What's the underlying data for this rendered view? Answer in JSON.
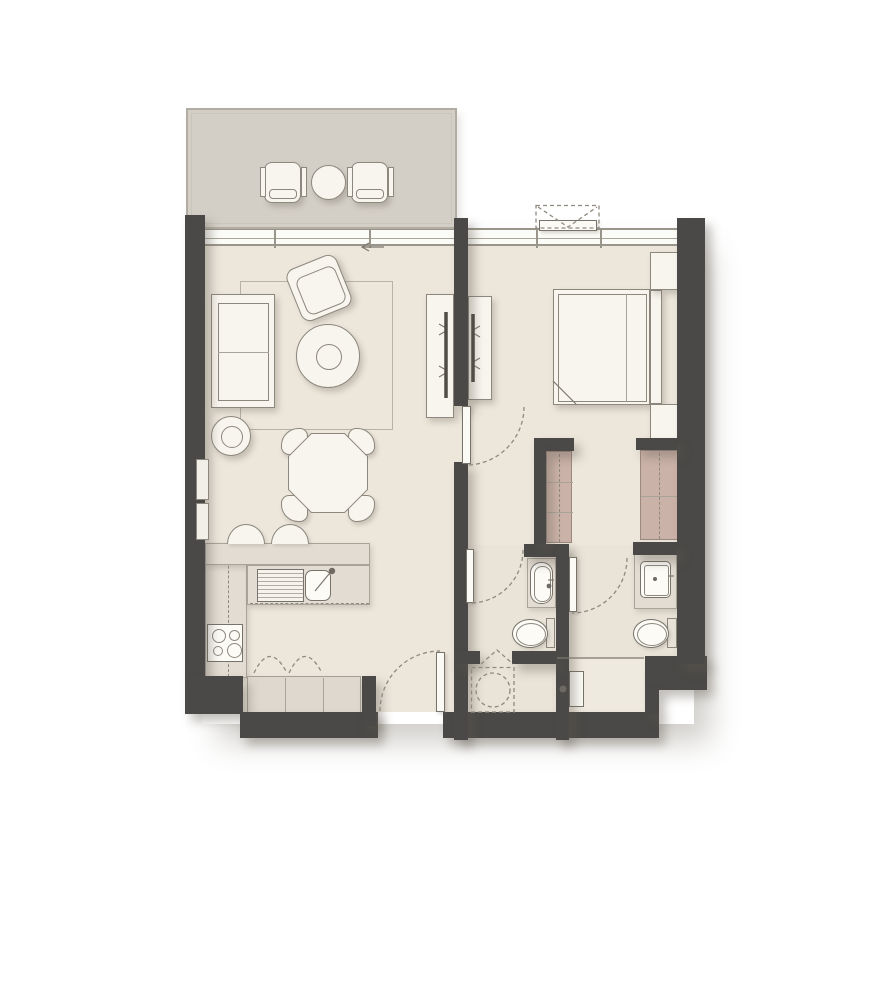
{
  "meta": {
    "title": "one-bedroom-apartment-floor-plan",
    "plan_type": "residential unit plan",
    "width": 889,
    "height": 1001
  },
  "colors": {
    "wall": "#4a4947",
    "floor": "#ece6db",
    "floor_bath": "#e9e3d8",
    "floor_light": "#efeadf",
    "balcony": "#d3cfc7",
    "furniture": "#f8f5ee",
    "furniture_line": "#8d887e",
    "counter": "#e2dcd2",
    "cabinet": "#ded8ce",
    "wardrobe": "#cbb2a8",
    "background": "#ffffff"
  },
  "rooms": [
    {
      "name": "balcony"
    },
    {
      "name": "living-dining-room"
    },
    {
      "name": "kitchen"
    },
    {
      "name": "entrance-hall"
    },
    {
      "name": "bedroom"
    },
    {
      "name": "bathroom"
    },
    {
      "name": "ensuite-bathroom"
    },
    {
      "name": "utility-closet"
    },
    {
      "name": "shower-area"
    }
  ],
  "elements": [
    {
      "name": "unit-shadow",
      "c": "shadow-rect",
      "x": 202,
      "y": 232,
      "w": 492,
      "h": 492
    },
    {
      "name": "balcony-floor",
      "c": "floor-balcony",
      "x": 187,
      "y": 109,
      "w": 269,
      "h": 119
    },
    {
      "name": "living-dining-floor",
      "c": "floor",
      "x": 205,
      "y": 228,
      "w": 250,
      "h": 484
    },
    {
      "name": "bedroom-floor",
      "c": "floor",
      "x": 455,
      "y": 228,
      "w": 222,
      "h": 317
    },
    {
      "name": "bathroom-floor",
      "c": "floor-bath",
      "x": 455,
      "y": 545,
      "w": 222,
      "h": 115
    },
    {
      "name": "utility-floor",
      "c": "floor-bath",
      "x": 455,
      "y": 660,
      "w": 190,
      "h": 52
    },
    {
      "name": "shower-floor",
      "c": "floor-light",
      "x": 568,
      "y": 659,
      "w": 77,
      "h": 53
    },
    {
      "name": "living-window-band",
      "c": "glass",
      "x": 205,
      "y": 228,
      "w": 250,
      "h": 18,
      "kids": [
        {
          "name": "window-rail",
          "c": "hline",
          "x": 0,
          "y": 8,
          "w": 250,
          "h": 1
        },
        {
          "name": "window-mullion",
          "c": "mull",
          "x": 69,
          "y": 0,
          "w": 2,
          "h": 18
        },
        {
          "name": "window-mullion",
          "c": "mull",
          "x": 164,
          "y": 0,
          "w": 2,
          "h": 18
        }
      ]
    },
    {
      "name": "bedroom-window-band",
      "c": "glass",
      "x": 468,
      "y": 228,
      "w": 209,
      "h": 18,
      "kids": [
        {
          "name": "window-rail",
          "c": "hline",
          "x": 0,
          "y": 8,
          "w": 209,
          "h": 1
        },
        {
          "name": "window-mullion",
          "c": "mull",
          "x": 68,
          "y": 0,
          "w": 2,
          "h": 18
        },
        {
          "name": "window-mullion",
          "c": "mull",
          "x": 132,
          "y": 0,
          "w": 2,
          "h": 18
        }
      ]
    },
    {
      "name": "living-rug",
      "c": "rug",
      "x": 240,
      "y": 281,
      "w": 153,
      "h": 149
    },
    {
      "name": "kitchen-counter-left",
      "c": "counter",
      "x": 205,
      "y": 543,
      "w": 42,
      "h": 135,
      "kids": [
        {
          "name": "counter-dash-line",
          "c": "dashv",
          "x": 22,
          "y": 2,
          "w": 1,
          "h": 131
        }
      ]
    },
    {
      "name": "kitchen-counter-bar",
      "c": "counter",
      "x": 205,
      "y": 543,
      "w": 165,
      "h": 22
    },
    {
      "name": "kitchen-counter-sink-run",
      "c": "counter",
      "x": 247,
      "y": 565,
      "w": 123,
      "h": 40,
      "kids": [
        {
          "name": "counter-dash-line",
          "c": "dashh",
          "x": 2,
          "y": 37,
          "w": 119,
          "h": 1
        }
      ]
    },
    {
      "name": "kitchen-lower-cabinets",
      "c": "cabinet",
      "x": 247,
      "y": 676,
      "w": 114,
      "h": 38,
      "kids": [
        {
          "name": "cabinet-divider",
          "c": "vline",
          "x": 37,
          "y": 1,
          "w": 1,
          "h": 36
        },
        {
          "name": "cabinet-divider",
          "c": "vline",
          "x": 75,
          "y": 1,
          "w": 1,
          "h": 36
        }
      ]
    },
    {
      "name": "sofa",
      "c": "furn",
      "x": 211,
      "y": 294,
      "w": 64,
      "h": 114,
      "kids": [
        {
          "name": "sofa-seat",
          "c": "hollow",
          "x": 6,
          "y": 8,
          "w": 51,
          "h": 98
        },
        {
          "name": "sofa-cushion-line",
          "c": "hline",
          "x": 6,
          "y": 57,
          "w": 51,
          "h": 1
        }
      ]
    },
    {
      "name": "side-table",
      "c": "furn circle",
      "x": 211,
      "y": 416,
      "w": 40,
      "h": 40,
      "kids": [
        {
          "name": "side-table-inner",
          "c": "hollow circle",
          "x": 9,
          "y": 9,
          "w": 22,
          "h": 22
        }
      ]
    },
    {
      "name": "armchair",
      "c": "furn",
      "x": 292,
      "y": 260,
      "w": 54,
      "h": 56,
      "r": -22,
      "br": "10px",
      "kids": [
        {
          "name": "armchair-seat",
          "c": "hollow",
          "x": 6,
          "y": 10,
          "w": 42,
          "h": 40,
          "br": "8px"
        }
      ]
    },
    {
      "name": "coffee-table",
      "c": "furn circle",
      "x": 296,
      "y": 324,
      "w": 64,
      "h": 64,
      "kids": [
        {
          "name": "coffee-table-ring",
          "c": "hollow circle",
          "x": 19,
          "y": 19,
          "w": 26,
          "h": 26
        }
      ]
    },
    {
      "name": "dining-chair",
      "c": "chair",
      "x": 281,
      "y": 428,
      "w": 27,
      "h": 27,
      "br": "65% 30% 30% 30%"
    },
    {
      "name": "dining-chair",
      "c": "chair",
      "x": 348,
      "y": 428,
      "w": 27,
      "h": 27,
      "br": "30% 65% 30% 30%"
    },
    {
      "name": "dining-chair",
      "c": "chair",
      "x": 281,
      "y": 495,
      "w": 27,
      "h": 27,
      "br": "30% 30% 30% 65%"
    },
    {
      "name": "dining-chair",
      "c": "chair",
      "x": 348,
      "y": 495,
      "w": 27,
      "h": 27,
      "br": "30% 30% 65% 30%"
    },
    {
      "name": "dining-table",
      "c": "oct",
      "x": 288,
      "y": 433,
      "w": 80,
      "h": 80,
      "kids": [
        {
          "name": "dining-table-top",
          "c": "oct fill-furn",
          "x": 1,
          "y": 1,
          "w": 78,
          "h": 78
        }
      ]
    },
    {
      "name": "tv-console-living",
      "c": "furn",
      "x": 426,
      "y": 294,
      "w": 28,
      "h": 124
    },
    {
      "name": "tv-console-bedroom",
      "c": "furn",
      "x": 468,
      "y": 296,
      "w": 24,
      "h": 104
    },
    {
      "name": "bed",
      "c": "furn",
      "x": 553,
      "y": 289,
      "w": 97,
      "h": 116,
      "kids": [
        {
          "name": "mattress-line",
          "c": "hollow",
          "x": 4,
          "y": 4,
          "w": 89,
          "h": 108
        },
        {
          "name": "duvet-line",
          "c": "vline",
          "x": 72,
          "y": 4,
          "w": 1,
          "h": 108
        }
      ]
    },
    {
      "name": "headboard",
      "c": "furn",
      "x": 650,
      "y": 290,
      "w": 12,
      "h": 114
    },
    {
      "name": "nightstand",
      "c": "furn",
      "x": 650,
      "y": 252,
      "w": 28,
      "h": 38
    },
    {
      "name": "nightstand",
      "c": "furn",
      "x": 650,
      "y": 404,
      "w": 28,
      "h": 38
    },
    {
      "name": "sink-drainer",
      "c": "drainer",
      "x": 257,
      "y": 569,
      "w": 47,
      "h": 33
    },
    {
      "name": "sink-basin",
      "c": "basin",
      "x": 305,
      "y": 570,
      "w": 26,
      "h": 31,
      "br": "7px"
    },
    {
      "name": "cooktop",
      "c": "basin",
      "x": 207,
      "y": 624,
      "w": 36,
      "h": 38,
      "kids": [
        {
          "name": "burner",
          "c": "hollow circle",
          "x": 4,
          "y": 4,
          "w": 14,
          "h": 14
        },
        {
          "name": "burner",
          "c": "hollow circle",
          "x": 21,
          "y": 5,
          "w": 11,
          "h": 11
        },
        {
          "name": "burner",
          "c": "hollow circle",
          "x": 5,
          "y": 21,
          "w": 10,
          "h": 10
        },
        {
          "name": "burner",
          "c": "hollow circle",
          "x": 19,
          "y": 18,
          "w": 15,
          "h": 15
        }
      ]
    },
    {
      "name": "bar-stool",
      "c": "stool",
      "x": 227,
      "y": 524,
      "w": 38,
      "h": 20
    },
    {
      "name": "bar-stool",
      "c": "stool",
      "x": 271,
      "y": 524,
      "w": 38,
      "h": 20
    },
    {
      "name": "balcony-chair",
      "c": "furn",
      "x": 264,
      "y": 162,
      "w": 37,
      "h": 41,
      "br": "8px",
      "kids": [
        {
          "name": "chair-arm",
          "c": "part",
          "x": -5,
          "y": 4,
          "w": 6,
          "h": 30
        },
        {
          "name": "chair-arm",
          "c": "part",
          "x": 36,
          "y": 4,
          "w": 6,
          "h": 30
        },
        {
          "name": "chair-seat-line",
          "c": "hollow",
          "x": 4,
          "y": 26,
          "w": 28,
          "h": 10,
          "br": "4px"
        }
      ]
    },
    {
      "name": "balcony-table",
      "c": "furn circle",
      "x": 311,
      "y": 165,
      "w": 35,
      "h": 35
    },
    {
      "name": "balcony-chair",
      "c": "furn",
      "x": 351,
      "y": 162,
      "w": 37,
      "h": 41,
      "br": "8px",
      "kids": [
        {
          "name": "chair-arm",
          "c": "part",
          "x": -5,
          "y": 4,
          "w": 6,
          "h": 30
        },
        {
          "name": "chair-arm",
          "c": "part",
          "x": 36,
          "y": 4,
          "w": 6,
          "h": 30
        },
        {
          "name": "chair-seat-line",
          "c": "hollow",
          "x": 4,
          "y": 26,
          "w": 28,
          "h": 10,
          "br": "4px"
        }
      ]
    },
    {
      "name": "balcony-parapet",
      "c": "parapet",
      "x": 186,
      "y": 108,
      "w": 271,
      "h": 121
    },
    {
      "name": "wardrobe-hall",
      "c": "wardrobe",
      "x": 546,
      "y": 451,
      "w": 26,
      "h": 92,
      "kids": [
        {
          "name": "wardrobe-rail-dash",
          "c": "dashv",
          "x": 12,
          "y": 2,
          "w": 1,
          "h": 88
        },
        {
          "name": "wardrobe-shelf-line",
          "c": "hline",
          "x": 0,
          "y": 30,
          "w": 26,
          "h": 1
        },
        {
          "name": "wardrobe-shelf-line",
          "c": "hline",
          "x": 0,
          "y": 60,
          "w": 26,
          "h": 1
        }
      ]
    },
    {
      "name": "wardrobe-bedroom",
      "c": "wardrobe",
      "x": 640,
      "y": 450,
      "w": 38,
      "h": 90,
      "kids": [
        {
          "name": "wardrobe-rail-dash",
          "c": "dashv",
          "x": 18,
          "y": 2,
          "w": 1,
          "h": 86
        },
        {
          "name": "wardrobe-shelf-line",
          "c": "hline",
          "x": 0,
          "y": 45,
          "w": 38,
          "h": 1
        }
      ]
    },
    {
      "name": "bathroom-vanity",
      "c": "counter",
      "x": 527,
      "y": 558,
      "w": 29,
      "h": 50
    },
    {
      "name": "bathroom-washbasin",
      "c": "basin",
      "x": 530,
      "y": 562,
      "w": 23,
      "h": 42,
      "br": "11px",
      "kids": [
        {
          "name": "basin-inner",
          "c": "hollow",
          "x": 3,
          "y": 3,
          "w": 17,
          "h": 36,
          "br": "8px"
        }
      ]
    },
    {
      "name": "toilet-cistern",
      "c": "tank",
      "x": 546,
      "y": 618,
      "w": 9,
      "h": 30
    },
    {
      "name": "toilet-bowl",
      "c": "bowl",
      "x": 512,
      "y": 619,
      "w": 36,
      "h": 29,
      "kids": [
        {
          "name": "bowl-inner",
          "c": "hollow circle",
          "x": 3,
          "y": 3,
          "w": 30,
          "h": 23
        }
      ]
    },
    {
      "name": "ensuite-vanity",
      "c": "counter",
      "x": 634,
      "y": 549,
      "w": 43,
      "h": 60
    },
    {
      "name": "ensuite-washbasin",
      "c": "basin",
      "x": 640,
      "y": 561,
      "w": 31,
      "h": 37,
      "br": "5px",
      "kids": [
        {
          "name": "basin-inner",
          "c": "hollow",
          "x": 3,
          "y": 3,
          "w": 25,
          "h": 31,
          "br": "3px"
        }
      ]
    },
    {
      "name": "ensuite-toilet-cistern",
      "c": "tank",
      "x": 667,
      "y": 618,
      "w": 10,
      "h": 30
    },
    {
      "name": "ensuite-toilet-bowl",
      "c": "bowl",
      "x": 633,
      "y": 619,
      "w": 36,
      "h": 29,
      "kids": [
        {
          "name": "bowl-inner",
          "c": "hollow circle",
          "x": 3,
          "y": 3,
          "w": 30,
          "h": 23
        }
      ]
    },
    {
      "name": "water-heater-panel",
      "c": "basin",
      "x": 569,
      "y": 671,
      "w": 15,
      "h": 36
    },
    {
      "name": "wall-left",
      "c": "wall",
      "x": 185,
      "y": 215,
      "w": 20,
      "h": 463
    },
    {
      "name": "wall-corner-sw",
      "c": "wall",
      "x": 185,
      "y": 676,
      "w": 58,
      "h": 38
    },
    {
      "name": "wall-bottom-kitchen",
      "c": "wall",
      "x": 240,
      "y": 712,
      "w": 138,
      "h": 26
    },
    {
      "name": "wall-entry-stub",
      "c": "wall",
      "x": 362,
      "y": 676,
      "w": 14,
      "h": 50
    },
    {
      "name": "wall-bottom-hall",
      "c": "wall",
      "x": 443,
      "y": 712,
      "w": 216,
      "h": 26
    },
    {
      "name": "wall-step-se",
      "c": "wall",
      "x": 645,
      "y": 656,
      "w": 62,
      "h": 34
    },
    {
      "name": "wall-step-se-leg",
      "c": "wall",
      "x": 645,
      "y": 688,
      "w": 14,
      "h": 26
    },
    {
      "name": "wall-right",
      "c": "wall",
      "x": 677,
      "y": 218,
      "w": 28,
      "h": 446
    },
    {
      "name": "wall-tv-partition",
      "c": "wall",
      "x": 454,
      "y": 218,
      "w": 14,
      "h": 188
    },
    {
      "name": "wall-partition-lower",
      "c": "wall",
      "x": 454,
      "y": 462,
      "w": 14,
      "h": 278
    },
    {
      "name": "wall-bathroom-top",
      "c": "wall",
      "x": 524,
      "y": 544,
      "w": 40,
      "h": 13
    },
    {
      "name": "wall-wardrobe-top",
      "c": "wall",
      "x": 534,
      "y": 438,
      "w": 40,
      "h": 13
    },
    {
      "name": "wall-wardrobe-side",
      "c": "wall",
      "x": 534,
      "y": 450,
      "w": 12,
      "h": 94
    },
    {
      "name": "wall-divider-mid",
      "c": "wall",
      "x": 556,
      "y": 544,
      "w": 13,
      "h": 196
    },
    {
      "name": "wall-bathroom-bottom-left",
      "c": "wall",
      "x": 454,
      "y": 651,
      "w": 26,
      "h": 13
    },
    {
      "name": "wall-bathroom-bottom-right",
      "c": "wall",
      "x": 512,
      "y": 651,
      "w": 44,
      "h": 13
    },
    {
      "name": "wall-ensuite-top",
      "c": "wall",
      "x": 633,
      "y": 542,
      "w": 44,
      "h": 13
    },
    {
      "name": "wall-wardrobe-right-top",
      "c": "wall",
      "x": 636,
      "y": 438,
      "w": 41,
      "h": 12
    },
    {
      "name": "wall-niche-window",
      "c": "niche",
      "x": 196,
      "y": 459,
      "w": 13,
      "h": 41
    },
    {
      "name": "wall-niche-window",
      "c": "niche",
      "x": 196,
      "y": 503,
      "w": 13,
      "h": 37
    },
    {
      "name": "casement-sash",
      "c": "leaf",
      "x": 539,
      "y": 220,
      "w": 58,
      "h": 11
    },
    {
      "name": "entrance-door-leaf",
      "c": "leaf",
      "x": 436,
      "y": 652,
      "w": 9,
      "h": 60
    },
    {
      "name": "bedroom-door-leaf",
      "c": "leaf",
      "x": 462,
      "y": 406,
      "w": 9,
      "h": 58
    },
    {
      "name": "bathroom-door-leaf",
      "c": "leaf",
      "x": 466,
      "y": 549,
      "w": 8,
      "h": 54
    },
    {
      "name": "ensuite-door-leaf",
      "c": "leaf",
      "x": 569,
      "y": 557,
      "w": 8,
      "h": 55
    }
  ],
  "linework": [
    {
      "name": "entrance-door-swing",
      "c": "dash",
      "d": "M 380 711 A 60 60 0 0 1 440 651"
    },
    {
      "name": "bedroom-door-swing",
      "c": "dash",
      "d": "M 524 407 A 58 58 0 0 1 466 465"
    },
    {
      "name": "bathroom-door-swing",
      "c": "dash",
      "d": "M 523 550 A 53 53 0 0 1 470 603"
    },
    {
      "name": "ensuite-door-swing",
      "c": "dash",
      "d": "M 627 558 A 55 55 0 0 1 572 613"
    },
    {
      "name": "utility-bifold-door",
      "c": "dash",
      "d": "M 481 664 L 497 650 L 513 664"
    },
    {
      "name": "cabinet-door-swing",
      "c": "dash",
      "d": "M 254 673 Q 270 640 287 673"
    },
    {
      "name": "cabinet-door-swing",
      "c": "dash",
      "d": "M 289 673 Q 305 640 322 673"
    },
    {
      "name": "washing-machine-outline",
      "c": "dash",
      "d": "M 471.5 667.5 H 514 V 712 H 471.5 Z"
    },
    {
      "name": "washing-machine-drum",
      "c": "dash",
      "d": "M 510 690 A 17 17 0 1 1 476 690 A 17 17 0 1 1 510 690"
    },
    {
      "name": "casement-window-box",
      "c": "dash",
      "d": "M 536 205.5 H 599 V 228 H 536 Z"
    },
    {
      "name": "casement-window-opening",
      "c": "dash",
      "d": "M 538 207 L 568 227 L 597 207"
    },
    {
      "name": "shower-divider-line",
      "c": "line",
      "d": "M 557 658 H 644"
    },
    {
      "name": "kitchen-faucet",
      "c": "line",
      "d": "M 315 591 L 329 574"
    },
    {
      "name": "sliding-door-arrow",
      "c": "line",
      "d": "M 384 247 H 362 M 369 243 L 362 247 L 369 251"
    },
    {
      "name": "tv-bracket-living",
      "c": "line",
      "d": "M 446 328 l -7 -4 M 446 331 l -7 4 M 446 370 l -7 -4 M 446 373 l -7 4"
    },
    {
      "name": "tv-bracket-bedroom",
      "c": "line",
      "d": "M 473 330 l 7 -4 M 473 333 l 7 4 M 473 362 l 7 -4 M 473 365 l 7 4"
    },
    {
      "name": "bed-fold-corner",
      "c": "line",
      "d": "M 553 381 L 576 404"
    },
    {
      "name": "bathroom-faucet",
      "c": "line",
      "d": "M 548 580 h 6"
    },
    {
      "name": "ensuite-faucet",
      "c": "line",
      "d": "M 668 576 h 6"
    },
    {
      "name": "shower-mixer-arm",
      "c": "line",
      "d": "M 566 689 h -6"
    },
    {
      "name": "tv-screen-living",
      "c": "tv",
      "d": "M 446 312 V 398"
    },
    {
      "name": "tv-screen-bedroom",
      "c": "tv",
      "d": "M 473 314 V 382"
    }
  ],
  "dots": [
    {
      "name": "kitchen-faucet-dot",
      "cx": 332,
      "cy": 571,
      "r": 3.2
    },
    {
      "name": "bathroom-faucet-dot",
      "cx": 549,
      "cy": 586,
      "r": 2.4
    },
    {
      "name": "ensuite-faucet-dot",
      "cx": 655,
      "cy": 579,
      "r": 2
    },
    {
      "name": "shower-mixer-knob",
      "cx": 563,
      "cy": 689,
      "r": 3.5
    }
  ]
}
